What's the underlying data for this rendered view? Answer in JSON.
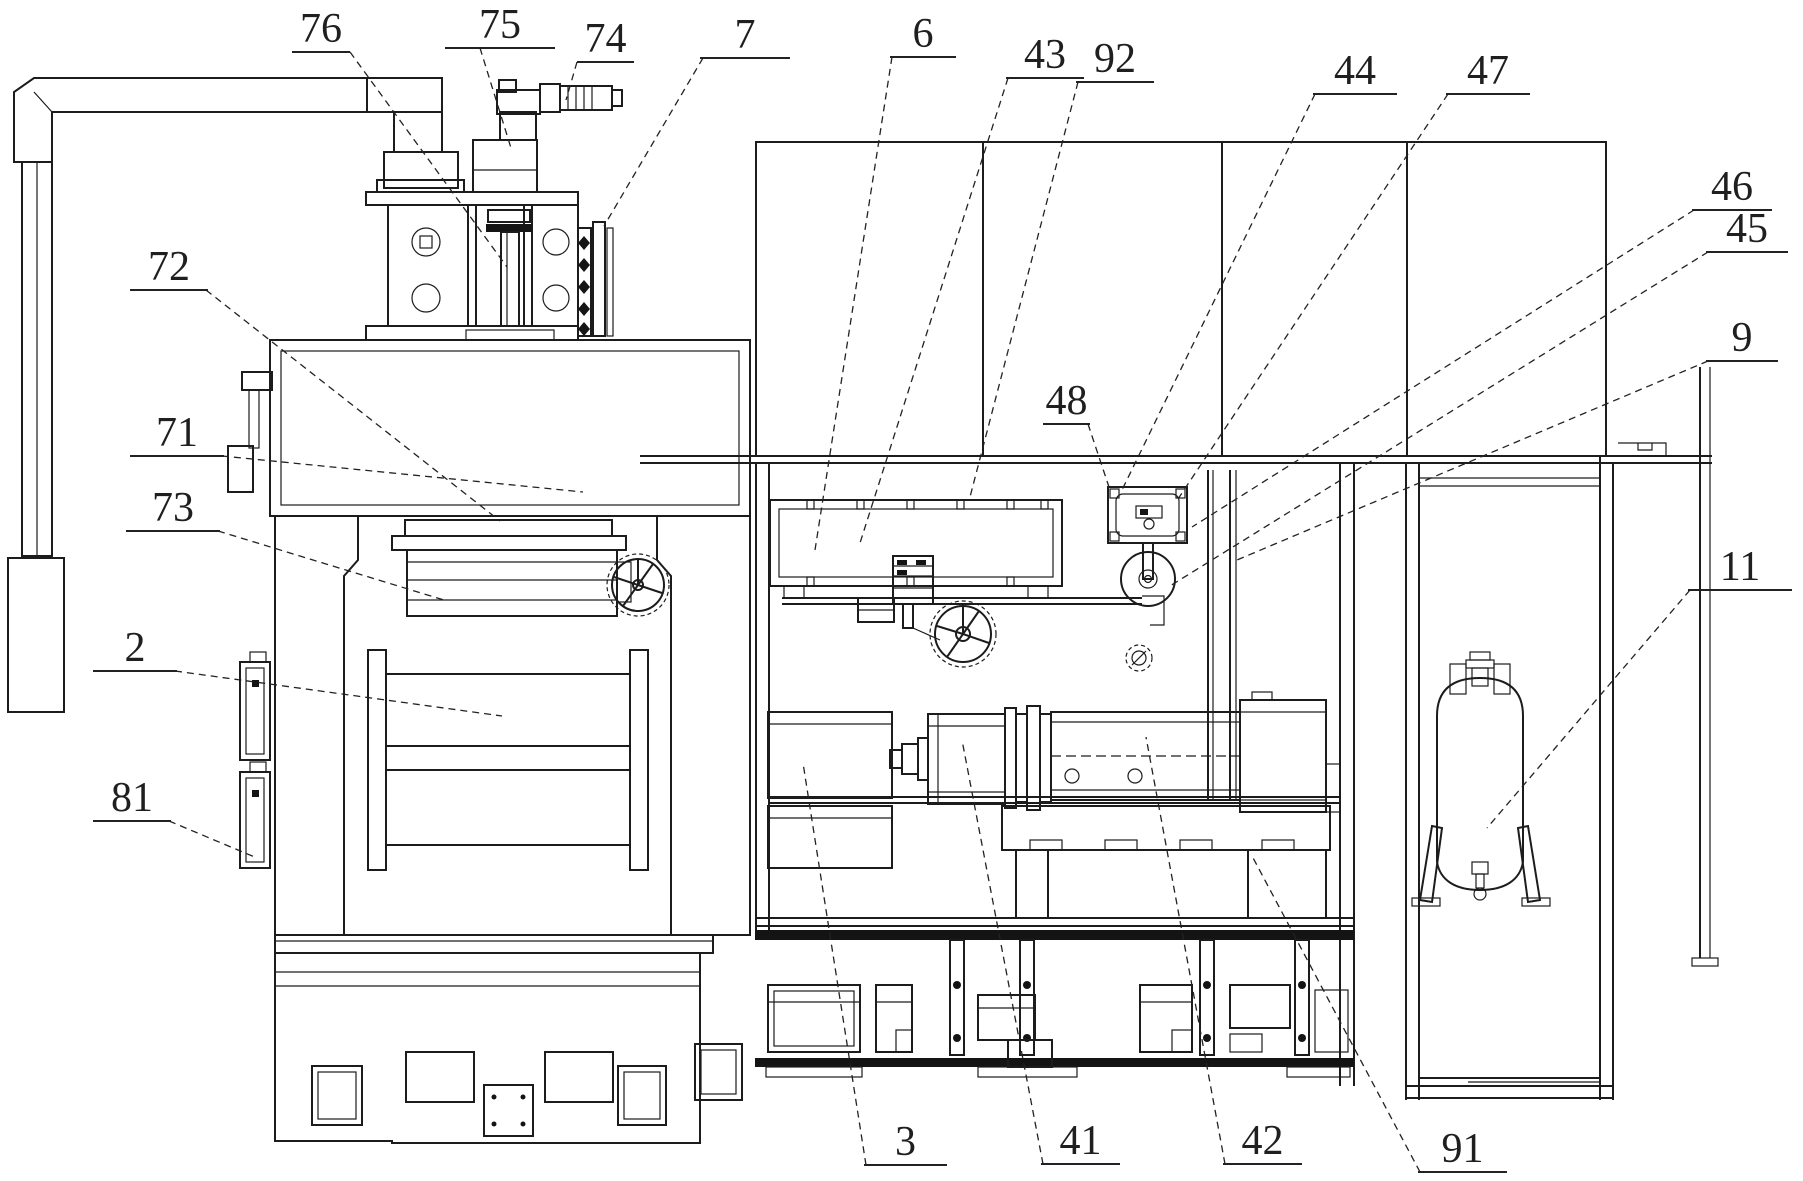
{
  "figure": {
    "background": "#ffffff",
    "line_color": "#1c1c1c",
    "label_color": "#1f1f1f",
    "label_font_size": 42
  },
  "labels": [
    {
      "text": "76",
      "ux1": 292,
      "ux2": 350,
      "uy": 52,
      "lx1": 350,
      "ly1": 52,
      "lx2": 507,
      "ly2": 267
    },
    {
      "text": "75",
      "ux1": 445,
      "ux2": 555,
      "uy": 48,
      "lx1": 480,
      "ly1": 48,
      "lx2": 511,
      "ly2": 148
    },
    {
      "text": "74",
      "ux1": 577,
      "ux2": 634,
      "uy": 62,
      "lx1": 577,
      "ly1": 62,
      "lx2": 566,
      "ly2": 100
    },
    {
      "text": "7",
      "ux1": 700,
      "ux2": 790,
      "uy": 58,
      "lx1": 703,
      "ly1": 58,
      "lx2": 604,
      "ly2": 226
    },
    {
      "text": "6",
      "ux1": 890,
      "ux2": 956,
      "uy": 57,
      "lx1": 892,
      "ly1": 57,
      "lx2": 815,
      "ly2": 550
    },
    {
      "text": "43",
      "ux1": 1006,
      "ux2": 1084,
      "uy": 78,
      "lx1": 1008,
      "ly1": 78,
      "lx2": 860,
      "ly2": 543
    },
    {
      "text": "92",
      "ux1": 1076,
      "ux2": 1154,
      "uy": 82,
      "lx1": 1078,
      "ly1": 82,
      "lx2": 970,
      "ly2": 497
    },
    {
      "text": "44",
      "ux1": 1313,
      "ux2": 1397,
      "uy": 94,
      "lx1": 1315,
      "ly1": 94,
      "lx2": 1122,
      "ly2": 490
    },
    {
      "text": "47",
      "ux1": 1446,
      "ux2": 1530,
      "uy": 94,
      "lx1": 1448,
      "ly1": 94,
      "lx2": 1178,
      "ly2": 499
    },
    {
      "text": "46",
      "ux1": 1692,
      "ux2": 1772,
      "uy": 210,
      "lx1": 1694,
      "ly1": 210,
      "lx2": 1192,
      "ly2": 527
    },
    {
      "text": "45",
      "ux1": 1706,
      "ux2": 1788,
      "uy": 252,
      "lx1": 1708,
      "ly1": 252,
      "lx2": 1170,
      "ly2": 586
    },
    {
      "text": "9",
      "ux1": 1706,
      "ux2": 1778,
      "uy": 361,
      "lx1": 1708,
      "ly1": 361,
      "lx2": 1237,
      "ly2": 560
    },
    {
      "text": "48",
      "ux1": 1043,
      "ux2": 1090,
      "uy": 424,
      "lx1": 1088,
      "ly1": 424,
      "lx2": 1109,
      "ly2": 487
    },
    {
      "text": "11",
      "ux1": 1688,
      "ux2": 1792,
      "uy": 590,
      "lx1": 1690,
      "ly1": 590,
      "lx2": 1487,
      "ly2": 828
    },
    {
      "text": "72",
      "ux1": 130,
      "ux2": 208,
      "uy": 290,
      "lx1": 206,
      "ly1": 290,
      "lx2": 500,
      "ly2": 521
    },
    {
      "text": "71",
      "ux1": 130,
      "ux2": 224,
      "uy": 456,
      "lx1": 222,
      "ly1": 456,
      "lx2": 583,
      "ly2": 492
    },
    {
      "text": "73",
      "ux1": 126,
      "ux2": 220,
      "uy": 531,
      "lx1": 218,
      "ly1": 531,
      "lx2": 444,
      "ly2": 600
    },
    {
      "text": "2",
      "ux1": 93,
      "ux2": 177,
      "uy": 671,
      "lx1": 175,
      "ly1": 671,
      "lx2": 502,
      "ly2": 716
    },
    {
      "text": "81",
      "ux1": 93,
      "ux2": 171,
      "uy": 821,
      "lx1": 169,
      "ly1": 821,
      "lx2": 257,
      "ly2": 858
    },
    {
      "text": "3",
      "ux1": 864,
      "ux2": 947,
      "uy": 1165,
      "lx1": 866,
      "ly1": 1165,
      "lx2": 803,
      "ly2": 763
    },
    {
      "text": "41",
      "ux1": 1041,
      "ux2": 1120,
      "uy": 1164,
      "lx1": 1043,
      "ly1": 1164,
      "lx2": 962,
      "ly2": 740
    },
    {
      "text": "42",
      "ux1": 1223,
      "ux2": 1302,
      "uy": 1164,
      "lx1": 1225,
      "ly1": 1164,
      "lx2": 1146,
      "ly2": 737
    },
    {
      "text": "91",
      "ux1": 1418,
      "ux2": 1507,
      "uy": 1172,
      "lx1": 1420,
      "ly1": 1172,
      "lx2": 1251,
      "ly2": 854
    }
  ]
}
